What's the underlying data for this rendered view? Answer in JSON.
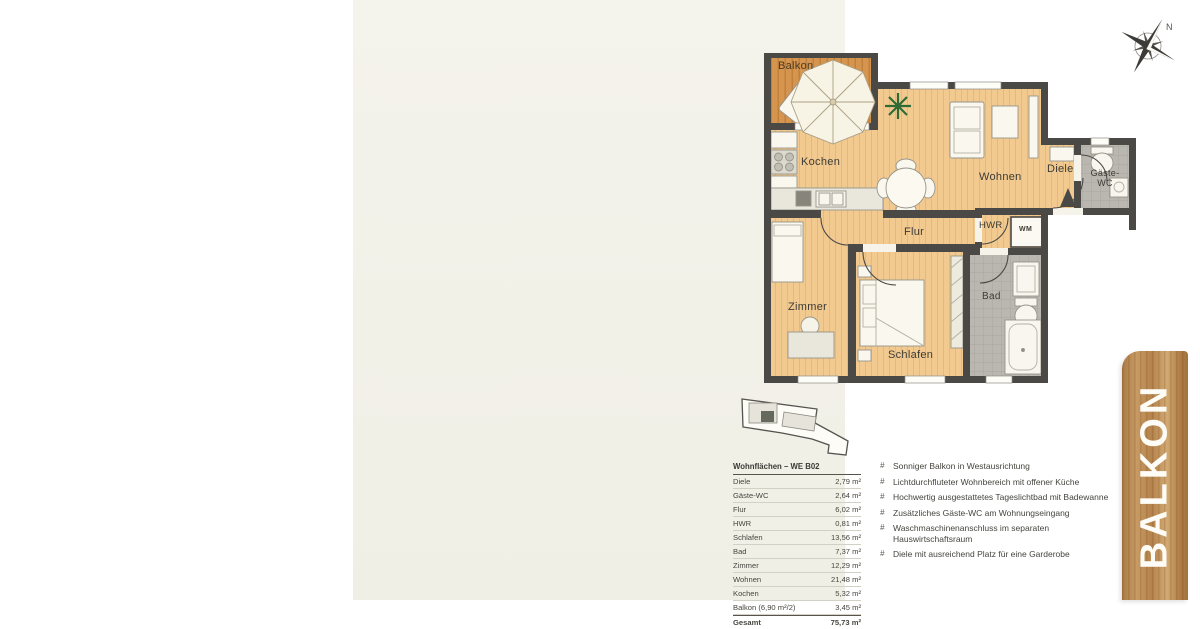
{
  "page": {
    "background": "#f3f2ea"
  },
  "compass": {
    "north_label": "N"
  },
  "floor_plan": {
    "labels": {
      "balkon": "Balkon",
      "kochen": "Kochen",
      "wohnen": "Wohnen",
      "diele": "Diele",
      "gaeste_wc": "Gäste-WC",
      "hwr": "HWR",
      "wm": "WM",
      "flur": "Flur",
      "zimmer": "Zimmer",
      "schlafen": "Schlafen",
      "bad": "Bad"
    },
    "colors": {
      "wall": "#4b4946",
      "wood_floor": "#f2ca90",
      "balcony_deck": "#d6954e",
      "tile_floor": "#bab7b0",
      "plant_green": "#2f6b34"
    }
  },
  "area_table": {
    "title": "Wohnflächen – WE B02",
    "rows": [
      {
        "label": "Diele",
        "value": "2,79 m²"
      },
      {
        "label": "Gäste-WC",
        "value": "2,64 m²"
      },
      {
        "label": "Flur",
        "value": "6,02 m²"
      },
      {
        "label": "HWR",
        "value": "0,81 m²"
      },
      {
        "label": "Schlafen",
        "value": "13,56 m²"
      },
      {
        "label": "Bad",
        "value": "7,37 m²"
      },
      {
        "label": "Zimmer",
        "value": "12,29 m²"
      },
      {
        "label": "Wohnen",
        "value": "21,48 m²"
      },
      {
        "label": "Kochen",
        "value": "5,32 m²"
      },
      {
        "label": "Balkon (6,90 m²/2)",
        "value": "3,45 m²"
      }
    ],
    "total": {
      "label": "Gesamt",
      "value": "75,73 m²"
    }
  },
  "features": {
    "bullet": "#",
    "items": [
      "Sonniger Balkon in Westausrichtung",
      "Lichtdurchfluteter Wohnbereich mit offener Küche",
      "Hochwertig ausgestattetes Tageslichtbad mit Badewanne",
      "Zusätzliches Gäste-WC am Wohnungseingang",
      "Waschmaschinenanschluss im separaten\nHauswirtschaftsraum",
      "Diele mit ausreichend Platz für eine Garderobe"
    ]
  },
  "banner": {
    "text": "BALKON"
  }
}
